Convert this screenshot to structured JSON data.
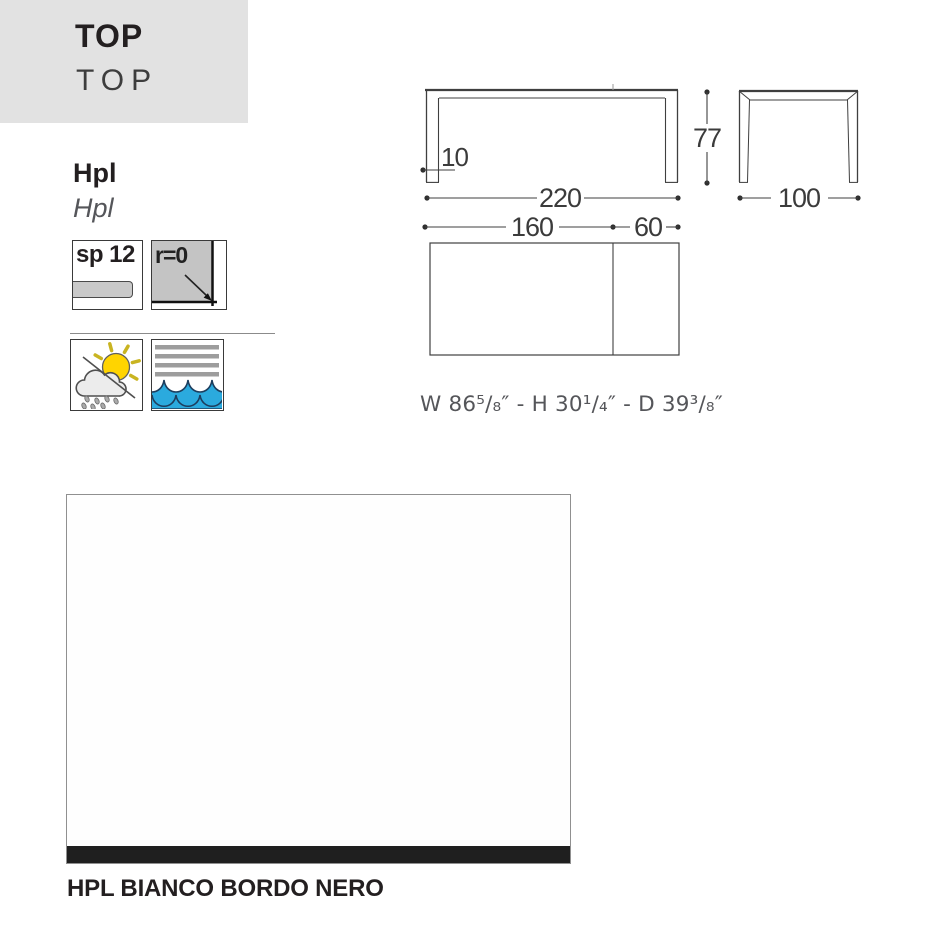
{
  "header": {
    "title": "TOP",
    "title_translation": "TOP"
  },
  "material": {
    "name": "Hpl",
    "name_translation": "Hpl"
  },
  "properties": {
    "thickness_label": "sp 12",
    "corner_radius_label": "r=0"
  },
  "feature_icons": {
    "outdoor": "sun-cloud-rain-icon",
    "water": "water-waves-icon"
  },
  "dimensions": {
    "total_width_cm": "220",
    "fixed_top_cm": "160",
    "extension_cm": "60",
    "height_cm": "77",
    "depth_cm": "100",
    "leg_thickness_cm": "10",
    "imperial": "W 86⁵/₈″ - H 30¹/₄″ - D 39³/₈″"
  },
  "finish": {
    "name": "HPL BIANCO BORDO NERO"
  },
  "colors": {
    "header_bg": "#e2e2e2",
    "water_blue": "#2baade",
    "wave_outline": "#1d3e5e",
    "sun_yellow": "#ffd400",
    "edge_black": "#1f1f1f",
    "line_gray": "#3f3f3f"
  }
}
